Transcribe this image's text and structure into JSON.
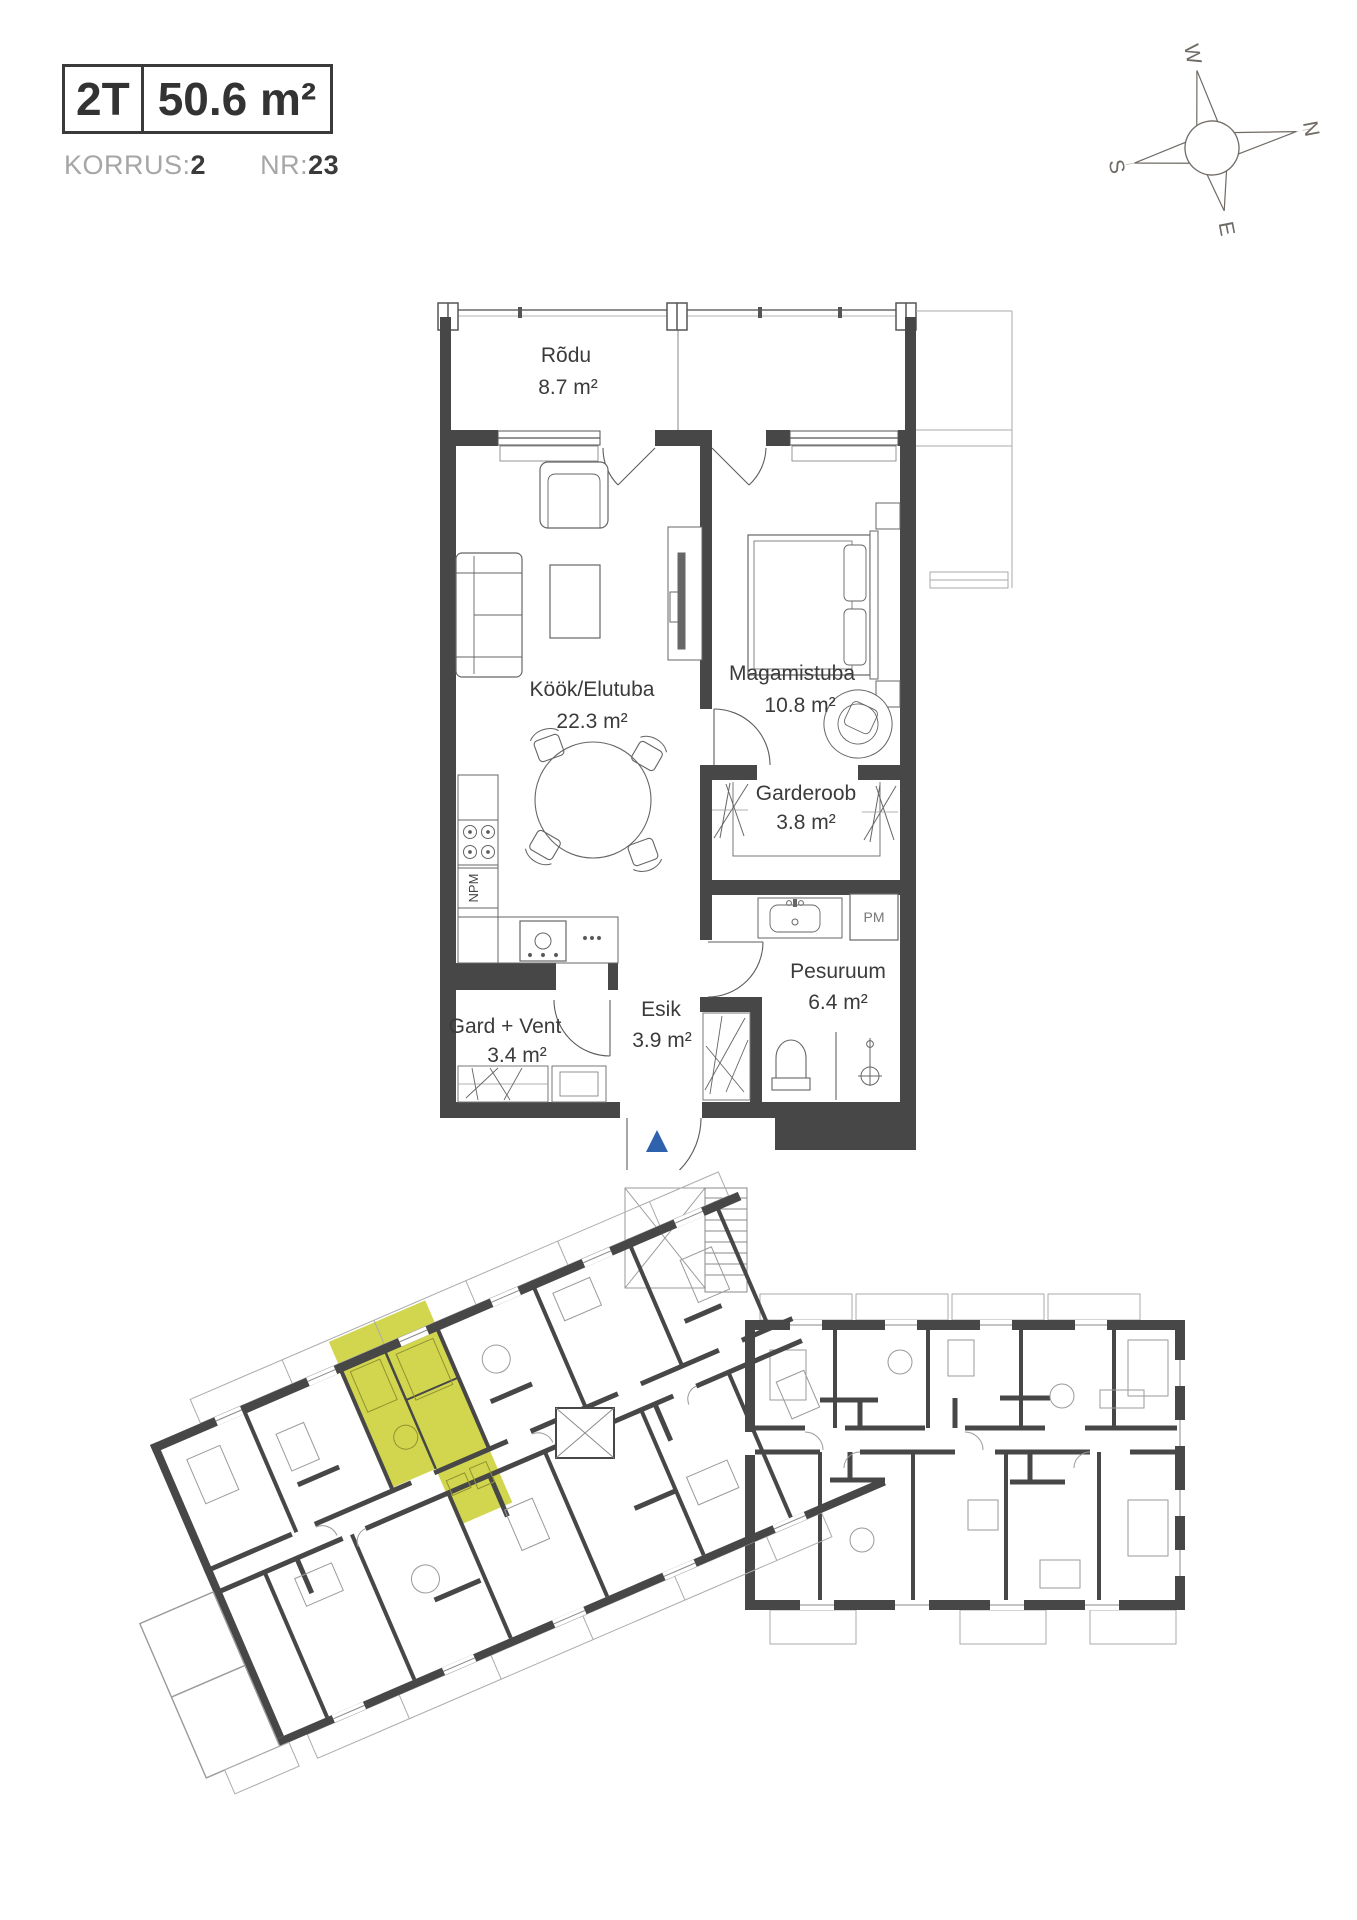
{
  "header": {
    "type_code": "2T",
    "area": "50.6 m²",
    "korrus_label": "KORRUS:",
    "korrus_value": "2",
    "nr_label": "NR:",
    "nr_value": "23"
  },
  "compass": {
    "n": "N",
    "e": "E",
    "s": "S",
    "w": "W"
  },
  "plan": {
    "rooms": [
      {
        "name": "Rõdu",
        "area": "8.7 m²"
      },
      {
        "name": "Köök/Elutuba",
        "area": "22.3 m²"
      },
      {
        "name": "Magamistuba",
        "area": "10.8 m²"
      },
      {
        "name": "Garderoob",
        "area": "3.8 m²"
      },
      {
        "name": "Pesuruum",
        "area": "6.4 m²"
      },
      {
        "name": "Esik",
        "area": "3.9 m²"
      },
      {
        "name": "Gard + Vent",
        "area": "3.4 m²"
      }
    ],
    "appliances": {
      "dishwasher": "NPM",
      "washing_machine": "PM"
    }
  },
  "colors": {
    "wall": "#474747",
    "highlight": "#d2d64e",
    "entry_arrow": "#2e62ac",
    "label": "#3b3b3b",
    "muted": "#a6a6a6"
  }
}
